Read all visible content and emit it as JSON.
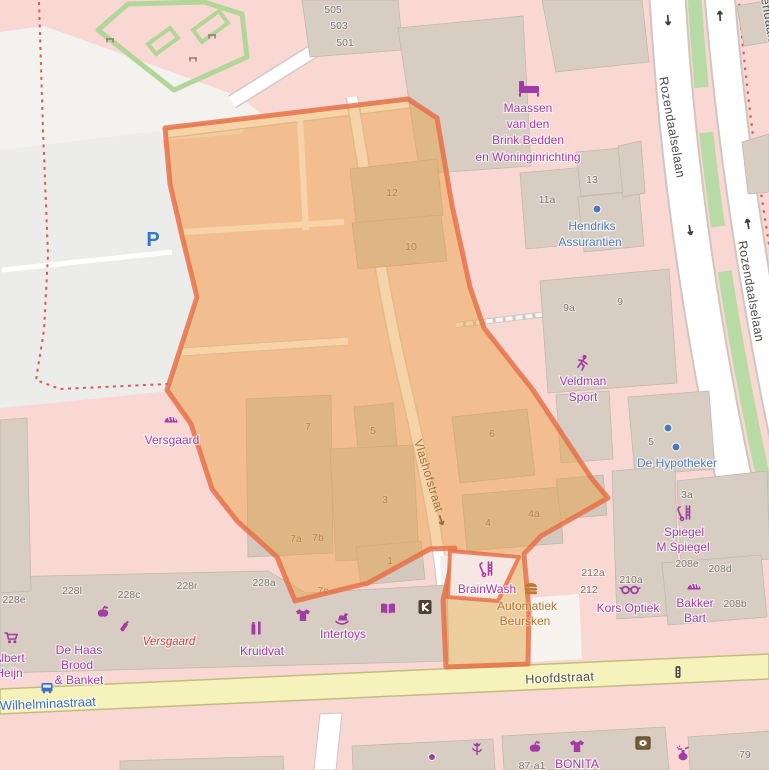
{
  "map": {
    "streets": {
      "rozendaalselaan": "Rozendaalselaan",
      "vlashofstraat": "Vlashofstraat",
      "hoofdstraat": "Hoofdstraat",
      "wilhelminastraat": "Wilhelminastraat"
    },
    "parking_symbol": "P",
    "house_numbers": [
      "505",
      "503",
      "501",
      "12",
      "10",
      "11a",
      "13",
      "9a",
      "9",
      "5",
      "3a",
      "208e",
      "208d",
      "212a",
      "212",
      "210a",
      "208b",
      "7",
      "5",
      "6",
      "3",
      "4",
      "4a",
      "7a",
      "7b",
      "7c",
      "1",
      "228e",
      "228l",
      "228c",
      "228r",
      "228a",
      "79",
      "87-a1"
    ],
    "pois": {
      "maassen": {
        "lines": [
          "Maassen",
          "van den",
          "Brink Bedden",
          "en Woninginrichting"
        ]
      },
      "hendriks": {
        "lines": [
          "Hendriks",
          "Assurantien"
        ]
      },
      "veldman": {
        "lines": [
          "Veldman",
          "Sport"
        ]
      },
      "hypotheker": {
        "label": "De Hypotheker"
      },
      "spiegel": {
        "lines": [
          "Spiegel",
          "M Spiegel"
        ]
      },
      "kors": {
        "label": "Kors Optiek"
      },
      "bakker": {
        "lines": [
          "Bakker",
          "Bart"
        ]
      },
      "brainwash": {
        "label": "BrainWash"
      },
      "automatiek": {
        "lines": [
          "Automatiek",
          "Beursken"
        ]
      },
      "versgaard_shop": {
        "label": "Versgaard"
      },
      "versgaard_vacant": {
        "label": "Versgaard"
      },
      "dehaas": {
        "lines": [
          "De Haas",
          "Brood",
          "& Banket"
        ]
      },
      "albert": {
        "lines": [
          "Albert",
          "Heijn"
        ]
      },
      "kruidvat": {
        "label": "Kruidvat"
      },
      "intertoys": {
        "label": "Intertoys"
      },
      "bonita": {
        "label": "BONITA"
      }
    },
    "icons": {
      "bed-icon": "bed pictogram (furniture shop)",
      "office-dot-icon": "blue office dot",
      "runner-icon": "running person (sports shop)",
      "hairdresser-icon": "comb and scissors",
      "glasses-icon": "optician glasses",
      "bakery-icon": "bread loaf",
      "burger-icon": "fast food burger",
      "clothing-icon": "t-shirt",
      "rocking-horse-icon": "toy shop",
      "book-icon": "open book",
      "kiosk-icon": "dark shop logo square",
      "cart-icon": "supermarket trolley",
      "apple-icon": "greengrocer apple",
      "cosmetics-icon": "cosmetics bottle",
      "chemist-icon": "chemist bottles",
      "perfume-icon": "perfume flask",
      "camera-icon": "brown photo square",
      "florist-icon": "tulip flower",
      "shop-dot-icon": "purple shop dot",
      "bus-stop-icon": "bus",
      "traffic-signals-icon": "traffic light",
      "bench-icon": "park bench",
      "oneway-arrow-icon": "one-way traffic arrow"
    },
    "colors": {
      "highlight_fill": "#eba03c",
      "highlight_stroke": "#e66c42",
      "shop_purple": "#a23ba3",
      "office_blue": "#4e79b6",
      "transit_blue": "#3f6fc1",
      "vacant_red": "#c9403c",
      "fastfood_orange": "#b5762f",
      "parking_blue": "#3476c9",
      "road_yellow": "#f5f3bb",
      "residential_pink": "#f9d8d3",
      "building_gray": "#d7cdc3",
      "park_green": "#b2d698"
    }
  }
}
